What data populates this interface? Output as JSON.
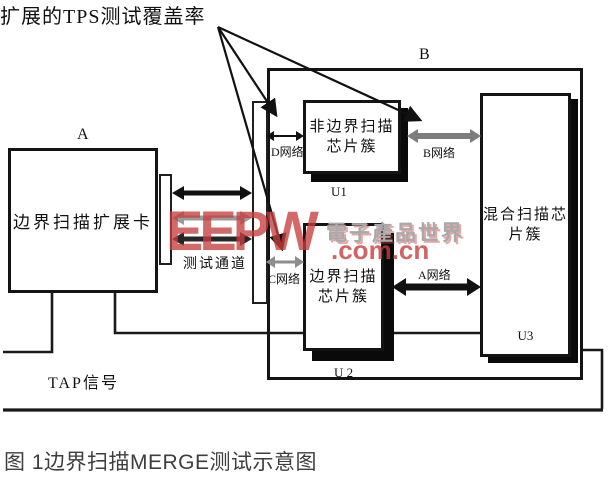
{
  "diagram": {
    "tps_label": "扩展的TPS测试覆盖率",
    "board_a_label": "A",
    "board_b_label": "B",
    "card_name": "边界扫描扩展卡",
    "test_channel_label": "测试通道",
    "tap_label": "TAP信号",
    "nets": {
      "a": "A网络",
      "b": "B网络",
      "c": "C网络",
      "d": "D网络"
    },
    "u1": {
      "line1": "非边界扫描",
      "line2": "芯片簇",
      "ref": "U1"
    },
    "u2": {
      "line1": "边界扫描",
      "line2": "芯片簇",
      "ref": "U 2"
    },
    "u3": {
      "line1": "混合扫描芯",
      "line2": "片簇",
      "ref": "U3"
    }
  },
  "watermark": {
    "logo": "EEPW",
    "site": "電子產品世界",
    "domain": ".com.cn",
    "accent_color": "#c63e3e"
  },
  "caption": "图 1边界扫描MERGE测试示意图"
}
